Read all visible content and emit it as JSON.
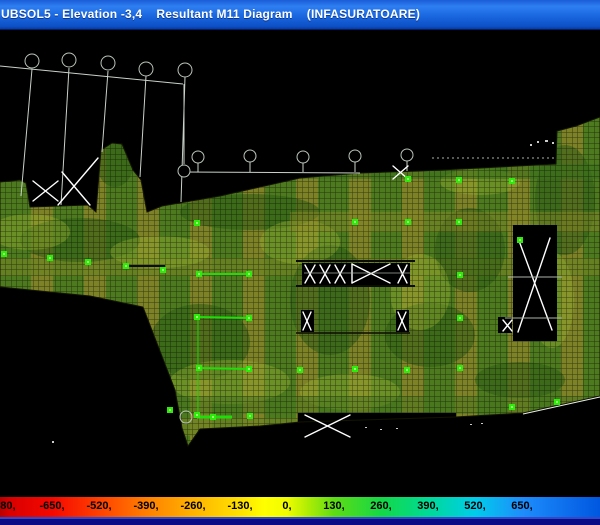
{
  "window": {
    "title": "UBSOL5 - Elevation -3,4    Resultant M11 Diagram    (INFASURATOARE)",
    "titlebar_color": "#1a67e0"
  },
  "canvas": {
    "background": "#000000",
    "mesh_base_color": "#4d7a1f",
    "mesh_band_color": "#7d8226",
    "node_marker_color": "#2dec0c",
    "construction_line_color": "#c8d2c8",
    "brace_color": "#ffffff"
  },
  "legend": {
    "labels": [
      "-780,",
      "-650,",
      "-520,",
      "-390,",
      "-260,",
      "-130,",
      "0,",
      "130,",
      "260,",
      "390,",
      "520,",
      "650,"
    ],
    "centers_px": [
      3,
      52,
      99,
      146,
      193,
      240,
      287,
      334,
      381,
      428,
      475,
      522
    ],
    "gradient_stops": [
      {
        "pos": "0%",
        "color": "#b80000"
      },
      {
        "pos": "1.5%",
        "color": "#d80000"
      },
      {
        "pos": "8.7%",
        "color": "#f50800"
      },
      {
        "pos": "16.5%",
        "color": "#ff4000"
      },
      {
        "pos": "24.3%",
        "color": "#ff7e00"
      },
      {
        "pos": "32.2%",
        "color": "#ffb300"
      },
      {
        "pos": "40%",
        "color": "#ffe100"
      },
      {
        "pos": "44%",
        "color": "#ffff00"
      },
      {
        "pos": "47.8%",
        "color": "#f0fc00"
      },
      {
        "pos": "51%",
        "color": "#b5ee04"
      },
      {
        "pos": "55.7%",
        "color": "#5edc14"
      },
      {
        "pos": "63.5%",
        "color": "#14d846"
      },
      {
        "pos": "71.3%",
        "color": "#00da96"
      },
      {
        "pos": "79.2%",
        "color": "#00cdea"
      },
      {
        "pos": "87%",
        "color": "#1e8dfc"
      },
      {
        "pos": "100%",
        "color": "#0057e0"
      }
    ]
  }
}
